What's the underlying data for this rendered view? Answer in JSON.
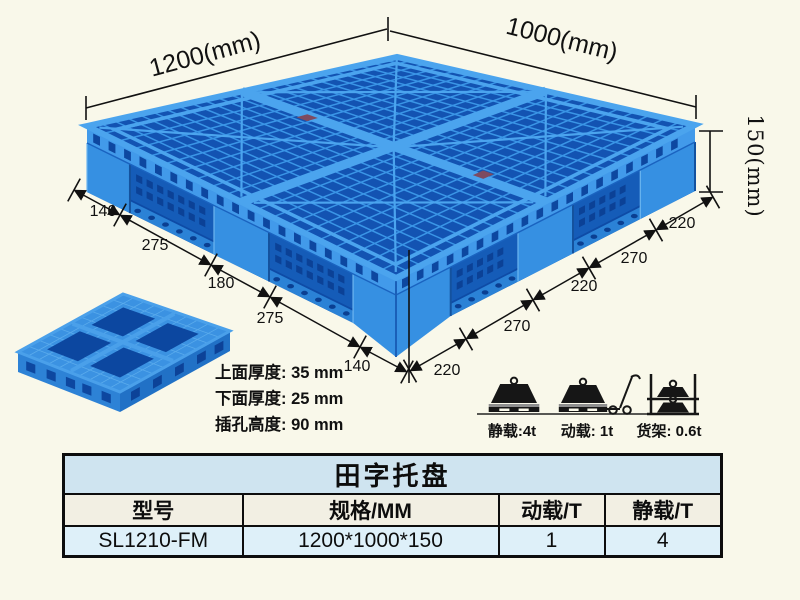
{
  "product": {
    "name": "田字托盘",
    "model": "SL1210-FM",
    "spec_mm": "1200*1000*150",
    "dynamic_load_t": "1",
    "static_load_t": "4"
  },
  "diagram": {
    "length_label": "1200(mm)",
    "width_label": "1000(mm)",
    "height_label": "150(mm)",
    "bottom_left_edge_segments_mm": [
      "140",
      "275",
      "180",
      "275",
      "140"
    ],
    "bottom_right_edge_segments_mm": [
      "220",
      "270",
      "220",
      "270",
      "220"
    ],
    "notes": {
      "top_thickness": "上面厚度: 35 mm",
      "bottom_thickness": "下面厚度: 25 mm",
      "fork_slot_height": "插孔高度: 90 mm"
    },
    "load_icons": {
      "static_label": "静载:4t",
      "dynamic_label": "动载: 1t",
      "rack_label": "货架: 0.6t"
    }
  },
  "table": {
    "title": "田字托盘",
    "headers": [
      "型号",
      "规格/MM",
      "动载/T",
      "静载/T"
    ],
    "rows": [
      [
        "SL1210-FM",
        "1200*1000*150",
        "1",
        "4"
      ]
    ]
  },
  "colors": {
    "background": "#f9f8ea",
    "pallet_blue": "#3690e2",
    "pallet_rib_blue": "#3a95e6",
    "pallet_dark_blue": "#0e4ba6",
    "table_title_bg": "#cfe4f0",
    "table_header_bg": "#f2efe3",
    "table_row_bg": "#def0f9",
    "line_color": "#111111"
  }
}
